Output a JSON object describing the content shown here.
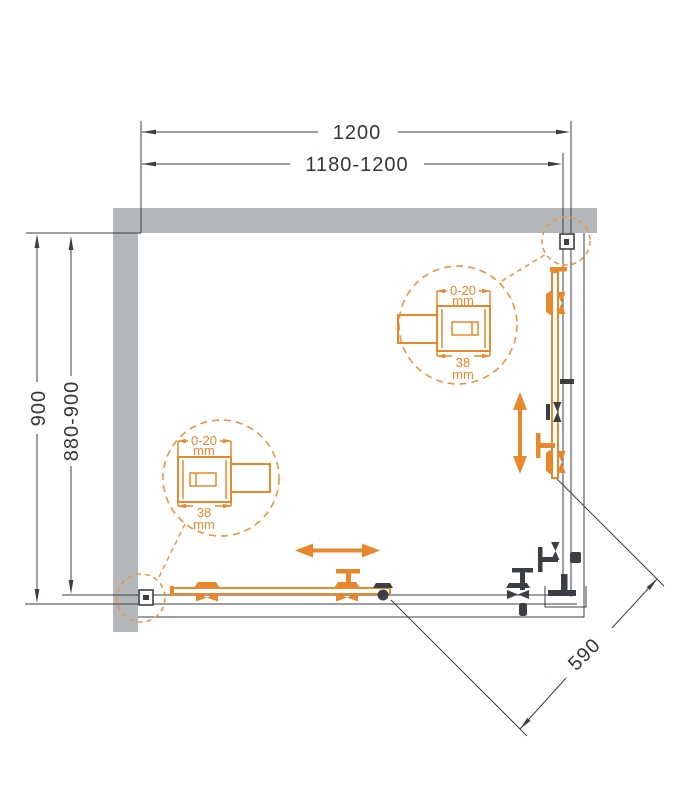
{
  "page": {
    "title": "Shower enclosure technical drawing - plan view"
  },
  "drawing": {
    "dimensions": {
      "width_total": "1200",
      "width_adjustable": "1180-1200",
      "depth_total": "900",
      "depth_adjustable": "880-900",
      "entry_diagonal": "590"
    },
    "callout_top_right": {
      "adjust_range": "0-20",
      "adjust_unit": "mm",
      "profile_width": "38",
      "profile_width_unit": "mm"
    },
    "callout_bottom_left": {
      "adjust_range": "0-20",
      "adjust_unit": "mm",
      "profile_width": "38",
      "profile_width_unit": "mm"
    },
    "colors": {
      "accent_orange": "#e8872c",
      "line_dark": "#3b3f43",
      "wall_gray": "#b4b7ba"
    }
  }
}
